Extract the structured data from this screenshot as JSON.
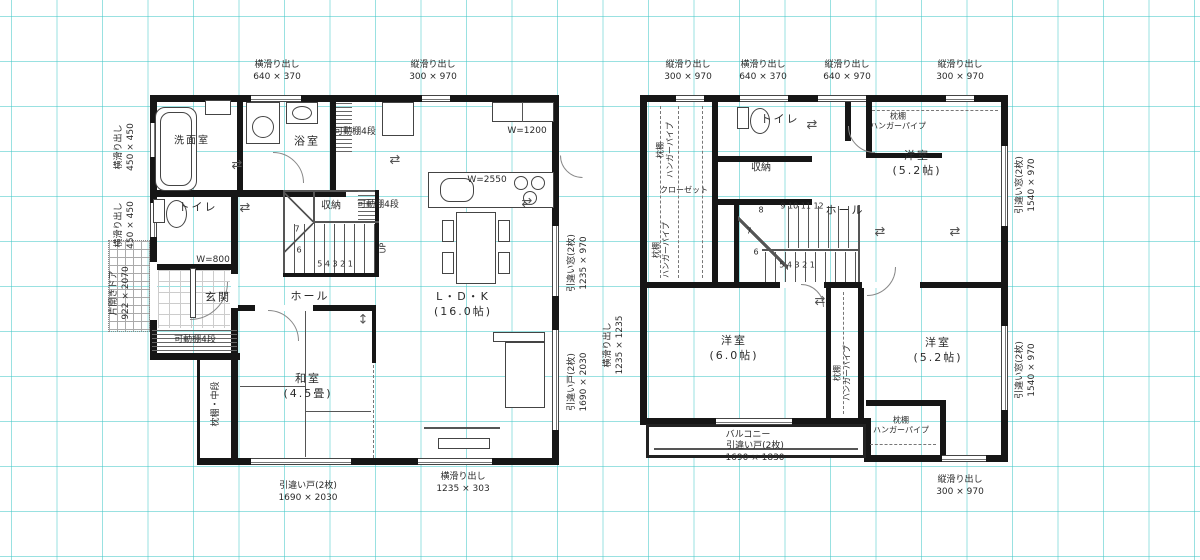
{
  "icons": {
    "h_arrow": "⇄",
    "v_arrow": "↕"
  },
  "f1": {
    "top_labels": [
      "横滑り出し\n640 × 370",
      "縦滑り出し\n300 × 970"
    ],
    "left_labels": [
      "横滑り出し\n450 × 450",
      "横滑り出し\n450 × 450",
      "片開きドア\n922 × 2070"
    ],
    "right_labels": [
      "引違い窓(2枚)\n1235 × 970",
      "引違い戸(2枚)\n1690 × 2030",
      "横滑り出し\n1235 × 1235"
    ],
    "bottom_labels": [
      "引違い戸(2枚)\n1690 × 2030",
      "横滑り出し\n1235 × 303"
    ],
    "rooms": {
      "senmen": "洗面室",
      "bath": "浴室",
      "shelf_top": "可動棚4段",
      "toilet": "トイレ",
      "shuno": "収納",
      "shelf_mid": "可動棚4段",
      "genkan": "玄関",
      "genkan_w": "W=800",
      "hall": "ホール",
      "ldk": "L・D・K\n(16.0帖)",
      "washitsu": "和室\n(4.5畳)",
      "shelf_btm": "可動棚4段",
      "oshiire": "枕棚・中段",
      "counter_w": "W=2550",
      "cupboard_w": "W=1200",
      "up": "UP"
    },
    "stairs": {
      "row": "5 4 3 2 1",
      "n6": "6",
      "n7": "7"
    }
  },
  "f2": {
    "top_labels": [
      "縦滑り出し\n300 × 970",
      "横滑り出し\n640 × 370",
      "縦滑り出し\n640 × 970",
      "縦滑り出し\n300 × 970"
    ],
    "right_labels": [
      "引違い窓(2枚)\n1540 × 970",
      "引違い窓(2枚)\n1540 × 970"
    ],
    "bottom_labels": [
      "縦滑り出し\n300 × 970"
    ],
    "rooms": {
      "toilet": "トイレ",
      "shuno": "収納",
      "closet": "クローゼット",
      "closet_left": "枕棚\nハンガーパイプ",
      "closet_left2": "枕棚\nハンガーパイプ",
      "hall": "ホール",
      "closet_tr": "枕棚\nハンガーパイプ",
      "yo_tr": "洋室\n(5.2帖)",
      "yo_bl": "洋室\n(6.0帖)",
      "yo_br": "洋室\n(5.2帖)",
      "closet_mid": "枕棚\nハンガーパイプ",
      "closet_br": "枕棚\nハンガーパイプ",
      "balcony": "バルコニー",
      "balcony_door": "引違い戸(2枚)\n1690 × 1830"
    },
    "stairs": {
      "row_top": "9 10 11 12",
      "n8": "8",
      "n7": "7",
      "n6": "6",
      "row_btm": "5 4 3 2 1"
    }
  }
}
